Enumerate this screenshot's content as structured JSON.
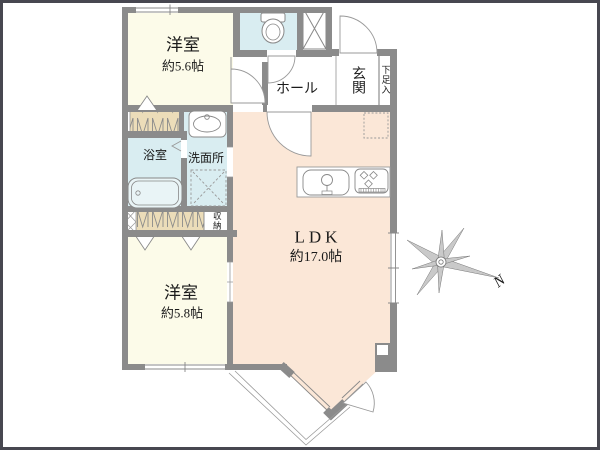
{
  "plan": {
    "rooms": {
      "bedroom1": {
        "name": "洋室",
        "size": "約5.6帖"
      },
      "bedroom2": {
        "name": "洋室",
        "size": "約5.8帖"
      },
      "ldk": {
        "name": "LDK",
        "size": "約17.0帖"
      },
      "hall": {
        "name": "ホール"
      },
      "entrance": {
        "name": "玄関"
      },
      "shoe_storage": {
        "name": "下足入"
      },
      "bathroom": {
        "name": "浴室"
      },
      "washroom": {
        "name": "洗面所"
      },
      "storage": {
        "name": "収納"
      }
    },
    "fixtures": [
      "toilet-icon",
      "bathtub-icon",
      "washbasin-icon",
      "washing-machine-icon",
      "kitchen-sink-icon",
      "gas-stove-icon",
      "refrigerator-icon",
      "meter-box-icon",
      "pipe-shaft-icon"
    ],
    "compass": {
      "north_label": "N"
    }
  },
  "colors": {
    "wall": "#8b8b8b",
    "ivory": "#fcfbe9",
    "peach": "#fbe7d7",
    "blue": "#d9edf1",
    "tan": "#ecddb9",
    "tub": "#e9f4f6",
    "line": "#999999",
    "frame": "#474750",
    "text": "#1a1a1a"
  }
}
